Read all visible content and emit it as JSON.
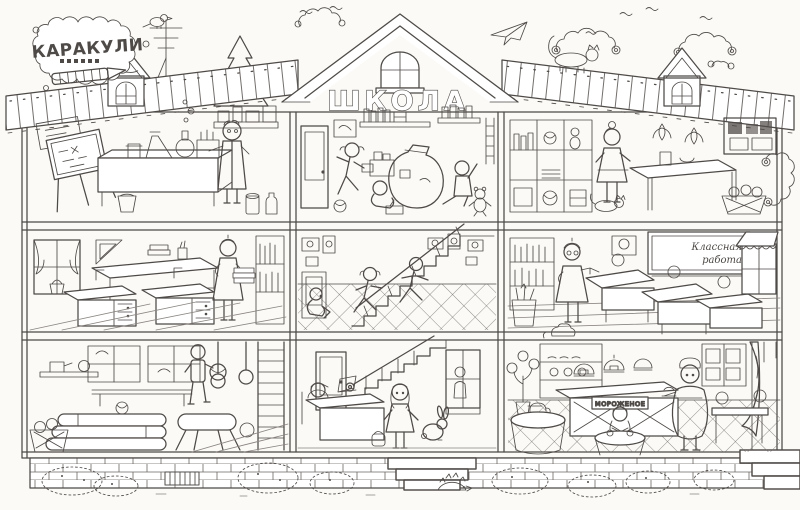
{
  "style": {
    "background": "#fbfaf7",
    "ink": "#4e4a47",
    "ink_light": "#8a8580",
    "paper": "#ffffff"
  },
  "logo": {
    "brand": "КАРАКУЛИ"
  },
  "building": {
    "sign": "ШКОЛА",
    "rooms": [
      {
        "id": "science-lab"
      },
      {
        "id": "playroom"
      },
      {
        "id": "nature-corner"
      },
      {
        "id": "classroom-left"
      },
      {
        "id": "staircase-hall"
      },
      {
        "id": "classroom-right"
      },
      {
        "id": "gym"
      },
      {
        "id": "entrance-lobby"
      },
      {
        "id": "cafeteria"
      }
    ]
  },
  "texts": {
    "chalkboard_line1": "Классная",
    "chalkboard_line2": "работа",
    "counter_sign": "МОРОЖЕНОЕ"
  }
}
